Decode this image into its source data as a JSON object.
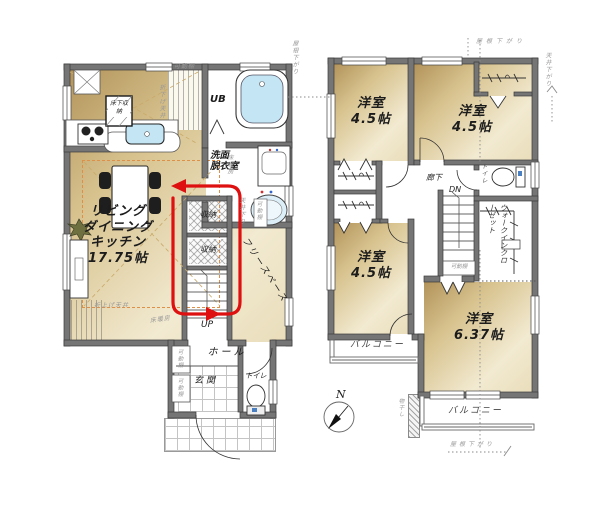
{
  "floor1": {
    "ldk": {
      "line1": "リビング",
      "line2": "ダイニング",
      "line3": "キッチン",
      "size": "17.75帖"
    },
    "labels": {
      "ub": "UB",
      "washroom1": "洗面",
      "washroom2": "脱衣室",
      "storage_a": "収納",
      "storage_b": "収納",
      "floor_storage": "床下収納",
      "free_space": "フリースペース",
      "up": "UP",
      "hall": "ホール",
      "entrance": "玄関",
      "toilet": "トイレ"
    },
    "annotations": {
      "kadodana_top": "可動棚",
      "orisage_tenjo": "折下げ天井",
      "yukadanbo_right": "床暖房",
      "tenjo_kudari": "天井下り",
      "kadodana_free": "可動棚",
      "oriage_tenjo": "折上げ天井",
      "yukadanbo_bottom": "床暖房",
      "kadodana_hall_1": "可動棚",
      "kadodana_hall_2": "可動棚"
    }
  },
  "floor2": {
    "rooms": {
      "bed1_name": "洋室",
      "bed1_size": "4.5帖",
      "bed2_name": "洋室",
      "bed2_size": "4.5帖",
      "bed3_name": "洋室",
      "bed3_size": "4.5帖",
      "bed4_name": "洋室",
      "bed4_size": "6.37帖"
    },
    "labels": {
      "corridor": "廊下",
      "dn": "DN",
      "toilet": "トイレ",
      "wic": "ウォークインクローゼット",
      "balcony_left": "バルコニー",
      "balcony_right": "バルコニー",
      "kadodana": "可動棚"
    },
    "annotations": {
      "roof_left": "屋根下がり",
      "roof_top": "屋根下がり",
      "ceiling_right": "天井下がり",
      "roof_bottom": "屋根下がり",
      "monohoshi": "物干し"
    }
  },
  "compass": {
    "north": "N"
  },
  "colors": {
    "wall": "#757575",
    "room_beige_dark": "#b2935a",
    "room_beige_light": "#f2ead1",
    "water_blue": "#c4e5f4",
    "flow_arrow_red": "#de1010",
    "annotation_gray": "#989898",
    "ceiling_dash_orange": "#de9049"
  }
}
